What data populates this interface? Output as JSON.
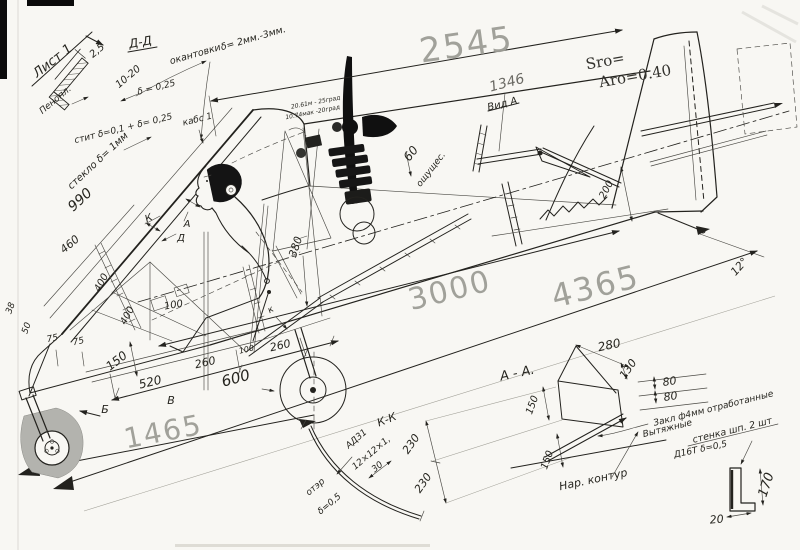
{
  "colors": {
    "paper": "#f8f7f3",
    "ink": "#23221e",
    "pencil": "#9d9d96"
  },
  "sheet": {
    "label": "Лист 1"
  },
  "detail_dd": {
    "title": "Д-Д",
    "dim_width": "2,5",
    "dim_height": "10-20",
    "skin": "δ = 0,25",
    "core": "Пенопл.",
    "edging_word": "окантовки",
    "edging_value": "δ= 2мм.-3мм.",
    "laminate": "стит δ=0,1 + δ= 0,25"
  },
  "canopy": {
    "glass_note": "стекло δ= 1мм",
    "frame_note": "кабс 1",
    "dim_990": "990",
    "dim_460": "460"
  },
  "cockpit": {
    "dim_400a": "400",
    "dim_400b": "400",
    "dim_100": "100",
    "dim_150": "150",
    "dim_380": "380",
    "dim_38": "38",
    "dim_50": "50",
    "dim_75a": "75",
    "dim_75b": "75",
    "marker_a": "А",
    "marker_d": "Д",
    "marker_k": "К",
    "marker_k_small": "к"
  },
  "lower_dims": {
    "dim_520": "520",
    "dim_260a": "260",
    "dim_100": "100",
    "dim_260b": "260",
    "dim_600": "600",
    "dim_1465": "1465",
    "marker_b": "Б",
    "marker_v": "В"
  },
  "overall": {
    "dim_2545": "2545",
    "dim_3000": "3000",
    "dim_4365": "4365",
    "dim_1346": "1346",
    "dim_200": "200",
    "dim_60": "60",
    "dim_60_note": "ощущес.",
    "angle_12": "12°"
  },
  "engine": {
    "note_line1": "20.61м - 25град",
    "note_line2": "10.74мак -20град"
  },
  "tail": {
    "sro": "Sro=",
    "aro": "Aro=0.40",
    "view_label": "Вид А"
  },
  "section_kk": {
    "title": "К-К",
    "material": "АД31",
    "profile": "12×12×1,",
    "thickness": "δ=0,5",
    "note": "отэр",
    "dim_30": "30",
    "dim_230a": "230",
    "dim_230b": "230"
  },
  "section_aa": {
    "title": "А - А.",
    "dim_280": "280",
    "dim_130": "130",
    "dim_80a": "80",
    "dim_80b": "80",
    "dim_150a": "150",
    "dim_150b": "150",
    "contour_label": "Нар. контур",
    "note_rivets": "Закл ф4мм отработанные",
    "note_pull": "Вытяжные",
    "note_wall": "стенка шп. 2 шт",
    "note_material": "Д16Т δ=0,5",
    "dim_170": "170",
    "dim_20": "20"
  }
}
